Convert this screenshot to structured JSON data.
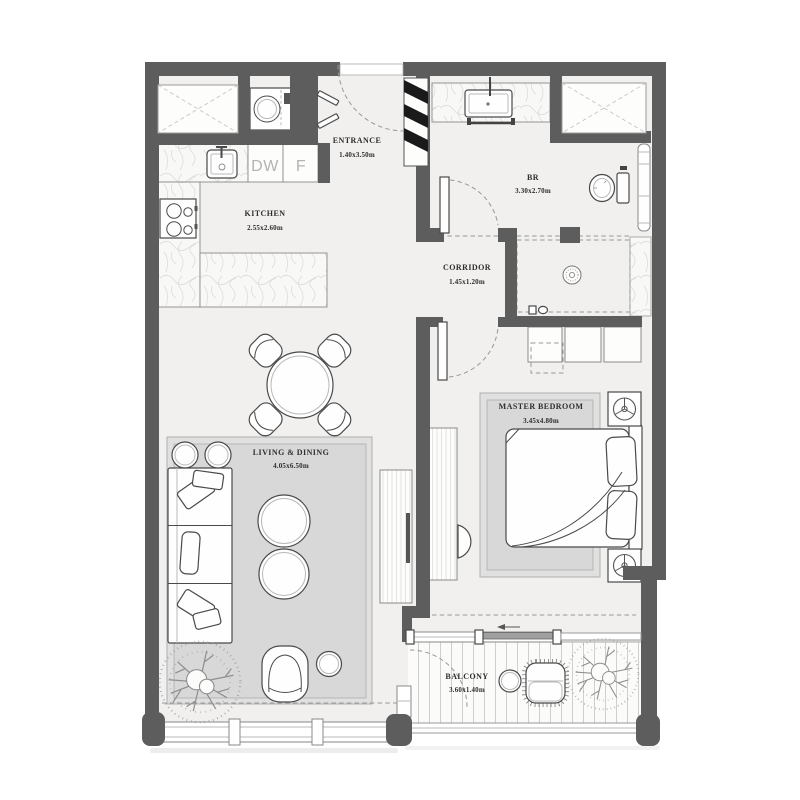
{
  "app": {
    "type": "apartment-floor-plan"
  },
  "rooms": {
    "entrance": {
      "name": "ENTRANCE",
      "dims": "1.40x3.50m"
    },
    "kitchen": {
      "name": "KITCHEN",
      "dims": "2.55x2.60m"
    },
    "bathroom": {
      "name": "BR",
      "dims": "3.30x2.70m"
    },
    "corridor": {
      "name": "CORRIDOR",
      "dims": "1.45x1.20m"
    },
    "living_dining": {
      "name": "LIVING & DINING",
      "dims": "4.05x6.50m"
    },
    "master_bedroom": {
      "name": "MASTER BEDROOM",
      "dims": "3.45x4.80m"
    },
    "balcony": {
      "name": "BALCONY",
      "dims": "3.60x1.40m"
    }
  },
  "appliances": {
    "dishwasher_label": "DW",
    "fridge_label": "F"
  },
  "colors": {
    "wall": "#5d5d5d",
    "floor": "#f1f0ee",
    "rug_outer": "#e0e0e0",
    "rug_inner": "#d8d8d8",
    "label_text": "#2e2e2e",
    "appliance_text": "#b3b3b3",
    "furniture_stroke": "#4a4a4a",
    "sliding_panel": "#a0a0a0"
  }
}
